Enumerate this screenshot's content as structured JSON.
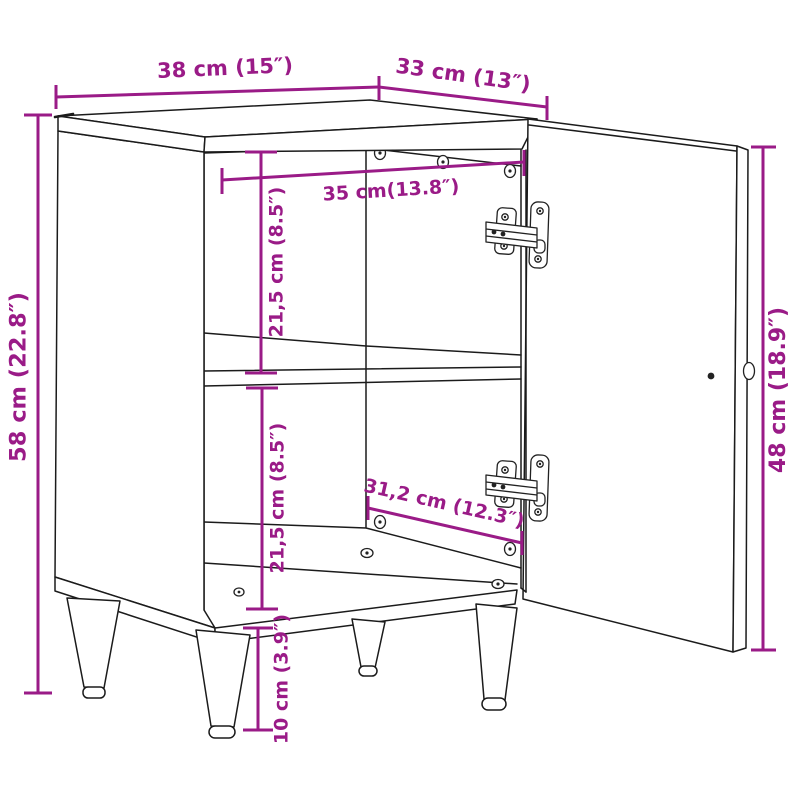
{
  "figure": {
    "title": "Cabinet dimension diagram",
    "subject": "Single-door cabinet shown with door open, inner shelf, back panel screws, two hinges and four tapered legs",
    "style": "technical line drawing on white background",
    "background_color": "#ffffff",
    "line_color": "#1b1b1b",
    "accent_color": "#9A1B87"
  },
  "dimensions": {
    "top_width": "38 cm (15″)",
    "top_depth": "33 cm (13″)",
    "overall_height": "58 cm (22.8″)",
    "interior_width": "35 cm(13.8″)",
    "upper_compartment_height": "21,5 cm (8.5″)",
    "lower_compartment_height": "21,5 cm (8.5″)",
    "interior_depth": "31,2 cm (12.3″)",
    "door_height": "48 cm (18.9″)",
    "leg_height": "10 cm (3.9″)"
  }
}
